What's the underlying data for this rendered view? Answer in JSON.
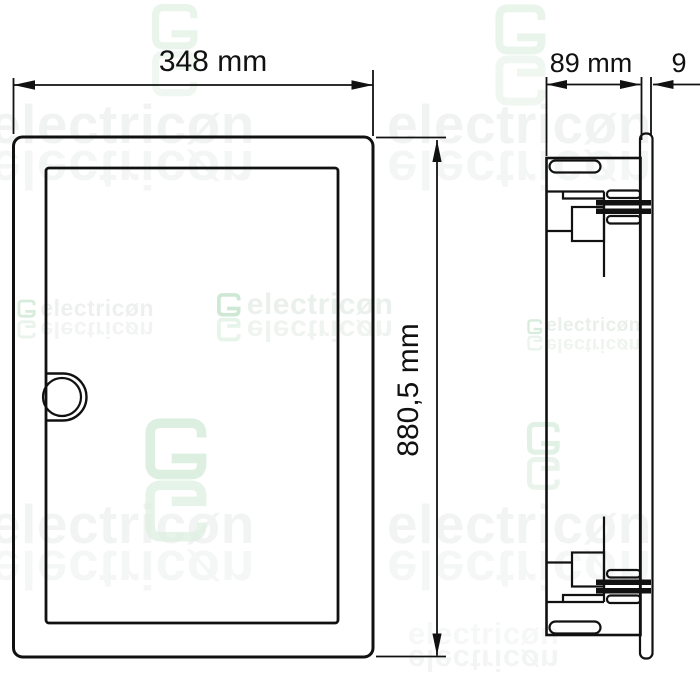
{
  "dimensions": {
    "front_width_label": "348 mm",
    "front_height_label": "880,5 mm",
    "side_depth_label": "89 mm",
    "side_offset_label": "9"
  },
  "watermark": {
    "brand_text": "electricøn"
  },
  "colors": {
    "line": "#111111",
    "watermark_gray": "#f1f3f2",
    "watermark_green": "#e9f4eb",
    "logo_green": "#cfe8d5"
  }
}
